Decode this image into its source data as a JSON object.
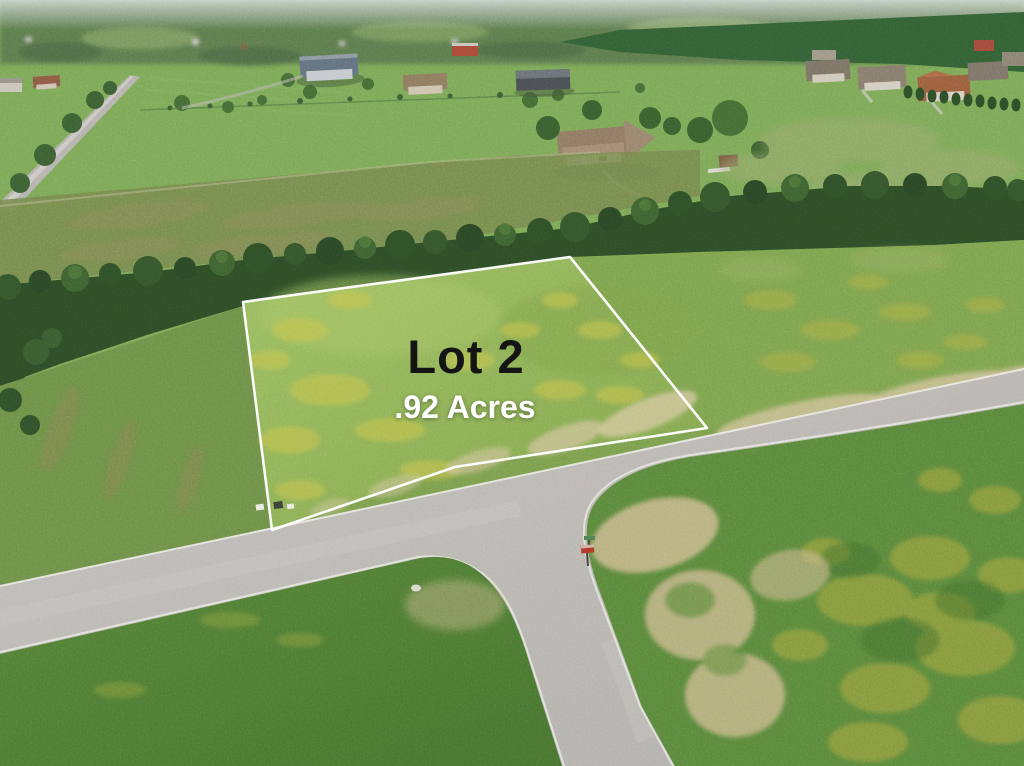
{
  "photo_overlay": {
    "lot_label": "Lot 2",
    "acres_label": ".92 Acres"
  },
  "scene": {
    "description": "Aerial drone photo of a vacant rural lot outlined in white near a T-intersection of two light gray roads, surrounded by green fields, tree lines and country houses",
    "boundary_color": "#ffffff",
    "lot_label_color": "#141414",
    "acres_label_color": "#ffffff",
    "road_color": "#b9b6b1",
    "lot_grass_color": "#8fb356",
    "treeline_color": "#2e4c27",
    "sand_color": "#cfc096",
    "flower_field_color": "#aaa83f"
  }
}
